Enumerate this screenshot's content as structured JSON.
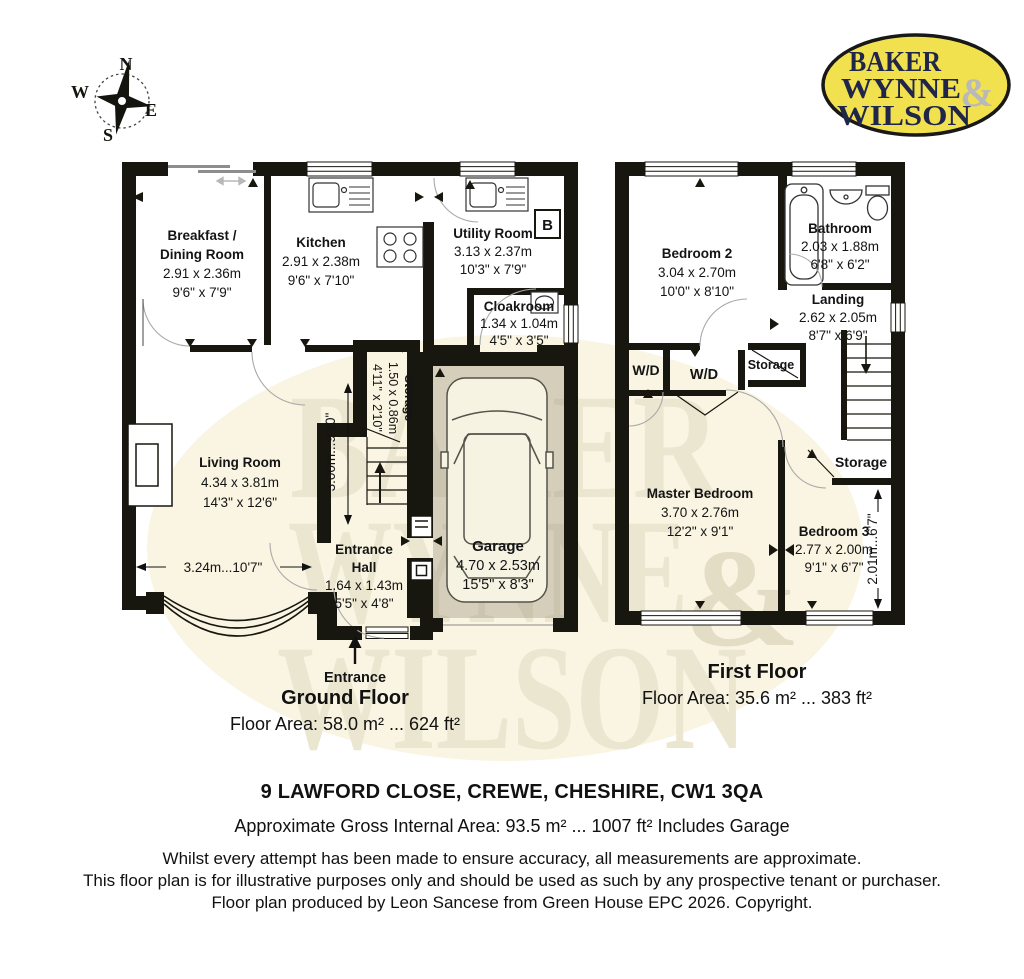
{
  "compass": {
    "n": "N",
    "e": "E",
    "s": "S",
    "w": "W"
  },
  "logo": {
    "l1": "BAKER",
    "l2": "WYNNE",
    "amp": "&",
    "l3": "WILSON"
  },
  "watermark": {
    "l1": "BAKER",
    "l2": "WYNNE",
    "amp": "&",
    "l3": "WILSON"
  },
  "colors": {
    "wall": "#17160f",
    "logo_yellow": "#f2e14e",
    "logo_navy": "#20264a",
    "watermark_fill": "#f9f5e2",
    "watermark_text": "#ebe6d0",
    "garage_tint": "#ddd9c7"
  },
  "gf": {
    "breakfast_1": "Breakfast /",
    "breakfast_2": "Dining Room",
    "breakfast_m": "2.91 x 2.36m",
    "breakfast_i": "9'6\" x 7'9\"",
    "kitchen": "Kitchen",
    "kitchen_m": "2.91 x 2.38m",
    "kitchen_i": "9'6\" x 7'10\"",
    "utility": "Utility Room",
    "utility_m": "3.13 x 2.37m",
    "utility_i": "10'3\" x 7'9\"",
    "boiler": "B",
    "cloak": "Cloakroom",
    "cloak_m": "1.34 x 1.04m",
    "cloak_i": "4'5\" x 3'5\"",
    "living": "Living Room",
    "living_m": "4.34 x 3.81m",
    "living_i": "14'3\" x 12'6\"",
    "storage": "Storage",
    "storage_m": "1.50 x 0.86m",
    "storage_i": "4'11\" x 2'10\"",
    "hall_1": "Entrance",
    "hall_2": "Hall",
    "hall_m": "1.64 x 1.43m",
    "hall_i": "5'5\" x 4'8\"",
    "garage": "Garage",
    "garage_m": "4.70 x 2.53m",
    "garage_i": "15'5\" x 8'3\"",
    "dim_v": "3.00m...9'10\"",
    "dim_h": "3.24m...10'7\"",
    "entrance": "Entrance",
    "title": "Ground Floor",
    "area": "Floor Area: 58.0 m² ... 624 ft²"
  },
  "ff": {
    "bed2": "Bedroom 2",
    "bed2_m": "3.04 x 2.70m",
    "bed2_i": "10'0\" x 8'10\"",
    "bath": "Bathroom",
    "bath_m": "2.03 x 1.88m",
    "bath_i": "6'8\" x 6'2\"",
    "landing": "Landing",
    "landing_m": "2.62 x 2.05m",
    "landing_i": "8'7\" x 6'9\"",
    "wd1": "W/D",
    "wd2": "W/D",
    "storage_top": "Storage",
    "storage_right": "Storage",
    "master": "Master Bedroom",
    "master_m": "3.70 x 2.76m",
    "master_i": "12'2\" x 9'1\"",
    "bed3": "Bedroom 3",
    "bed3_m": "2.77 x 2.00m",
    "bed3_i": "9'1\" x 6'7\"",
    "dim_v": "2.01m...6'7\"",
    "title": "First Floor",
    "area": "Floor Area: 35.6 m² ... 383 ft²"
  },
  "footer": {
    "address": "9 LAWFORD CLOSE, CREWE, CHESHIRE, CW1 3QA",
    "gross": "Approximate Gross Internal Area: 93.5 m² ... 1007 ft² Includes Garage",
    "d1": "Whilst every attempt has been made to ensure accuracy, all measurements are approximate.",
    "d2": "This floor plan is for illustrative purposes only and should be used as such by any prospective tenant or purchaser.",
    "d3": "Floor plan produced by Leon Sancese from Green House EPC 2026. Copyright."
  }
}
